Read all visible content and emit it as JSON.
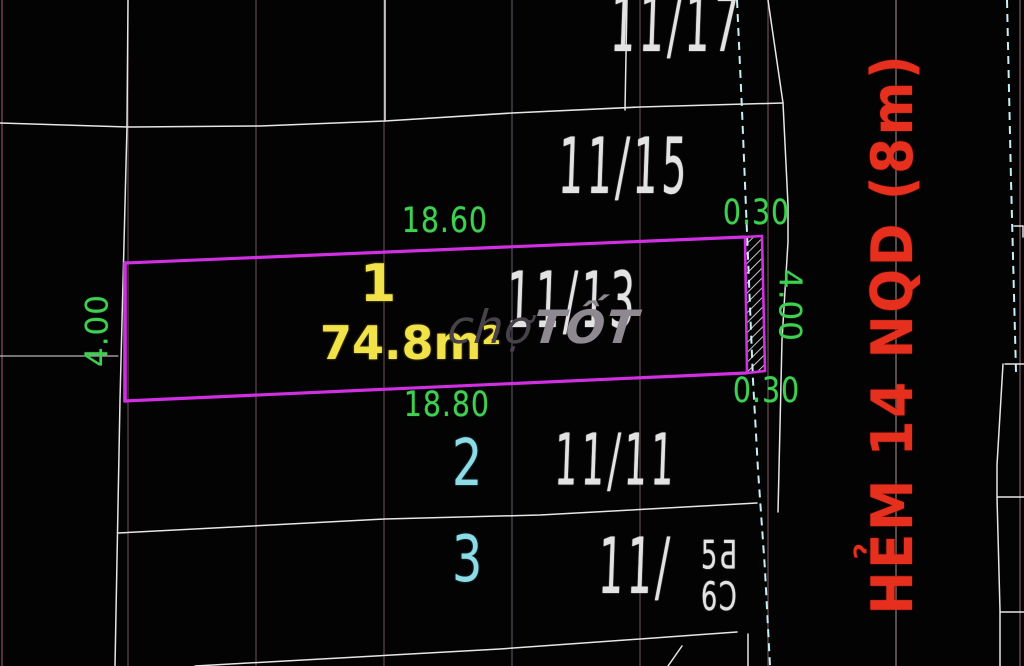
{
  "drawing": {
    "title": "cadastral-plot-sketch",
    "parcel": {
      "number": "1",
      "area": "74.8m²",
      "dim_top": "18.60",
      "dim_bottom": "18.80",
      "dim_left": "4.00",
      "dim_right": "4.00",
      "setback_top": "0.30",
      "setback_bottom": "0.30"
    },
    "houses": [
      {
        "label": "11/17"
      },
      {
        "label": "11/15"
      },
      {
        "label": "11/13"
      },
      {
        "label": "11/11"
      }
    ],
    "bottom_house": {
      "prefix": "11/",
      "upper": "5Ƌ",
      "lower": "6Ɔ"
    },
    "lots": {
      "lot2": "2",
      "lot3": "3"
    },
    "street": {
      "name": "HẺM 14 NQD (8m)"
    },
    "watermark": {
      "part1": "chợ",
      "part2": "TỐT"
    },
    "colors": {
      "plot_outline": "#d02fe2",
      "dimension_text": "#3fd052",
      "area_text": "#f2e24a",
      "lot_text": "#8fdbe5",
      "street_text": "#e6301d",
      "boundary_line": "#e6e6e6",
      "road_dash": "#c6f0f4",
      "grid_line": "#5f4646",
      "background": "#040304"
    }
  }
}
